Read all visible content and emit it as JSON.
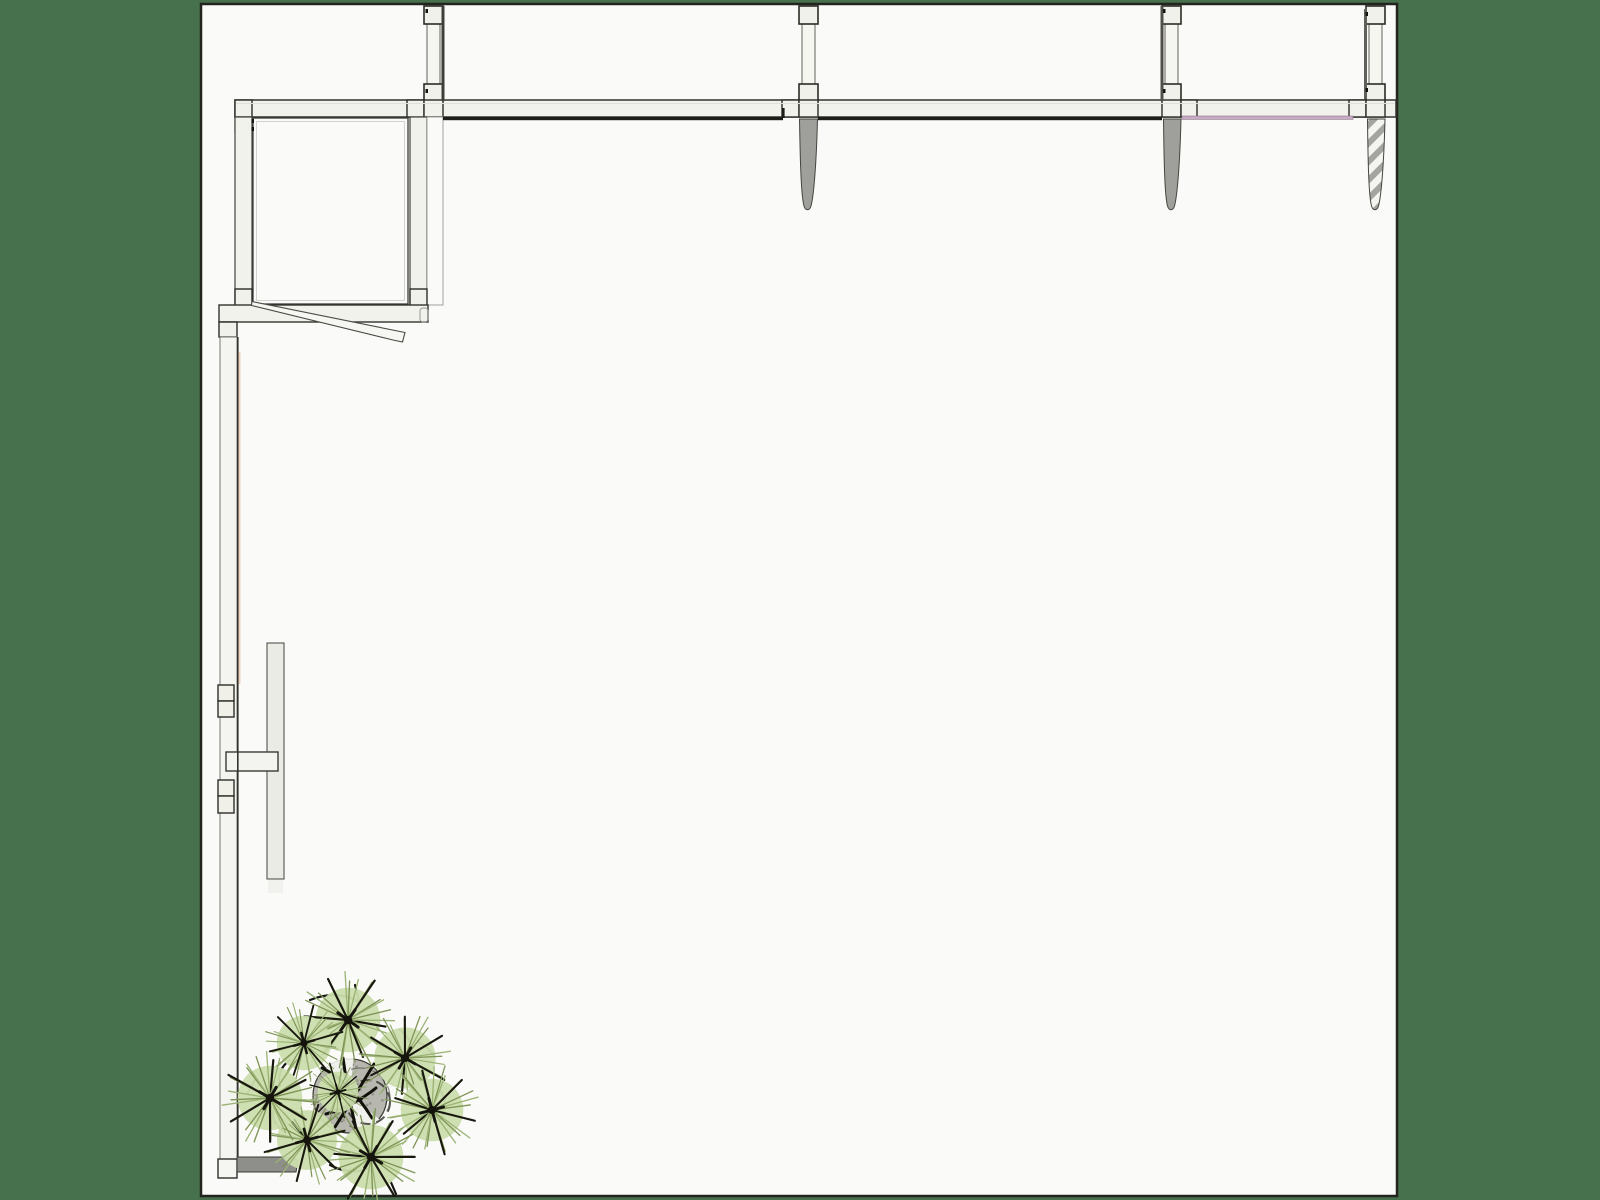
{
  "app": {
    "description": "Architectural CAD plan view drawing of a pergola corner structure with columns, cast shadows, a sliding door wall and a pine tree symbol",
    "background_color": "#47704c",
    "canvas_color": "#fafaf8",
    "line_color": "#2c2c27",
    "shadow_color": "#1d1d1a",
    "accent_pink": "#c7abc5",
    "accent_peach": "#e9c6ab",
    "plant_green": "#cbddad"
  },
  "drawing": {
    "canvas": {
      "name": "paper-canvas",
      "x": 201,
      "y": 4,
      "w": 1196,
      "h": 1192,
      "fill": "#fafaf8",
      "stroke": "#24241f",
      "sw": 2.5
    },
    "rects": [
      [
        "beam-top",
        235,
        100,
        1161,
        17,
        "#f2f2ed",
        "#33332e",
        1.5,
        0
      ],
      [
        "column-1-shaft",
        427,
        6,
        13,
        96,
        "#f6f6f1",
        "#63635d",
        1,
        0
      ],
      [
        "column-1-top-block",
        424,
        6,
        19,
        18,
        "#f1f1eb",
        "#2c2c27",
        1.6,
        0
      ],
      [
        "column-1-mid-block",
        424,
        84,
        19,
        17,
        "#f1f1eb",
        "#2c2c27",
        1.6,
        0
      ],
      [
        "column-1-beam-block-left",
        407,
        100,
        17,
        17,
        "#f2f2ec",
        "#2c2c27",
        1.4,
        0
      ],
      [
        "column-1-beam-block",
        424,
        100,
        19,
        17,
        "#f2f2ec",
        "#2c2c27",
        1.4,
        0
      ],
      [
        "column-1-under-block",
        424,
        117,
        18,
        15,
        "#f2f2ec",
        "#44443e",
        1.1,
        0
      ],
      [
        "column-2-shaft",
        802,
        6,
        13,
        96,
        "#f6f6f1",
        "#63635d",
        1,
        0
      ],
      [
        "column-2-top-block",
        799,
        6,
        19,
        18,
        "#f1f1eb",
        "#2c2c27",
        1.6,
        0
      ],
      [
        "column-2-mid-block",
        799,
        84,
        19,
        17,
        "#f1f1eb",
        "#2c2c27",
        1.6,
        0
      ],
      [
        "column-2-beam-block-left",
        782,
        100,
        17,
        17,
        "#f2f2ec",
        "#2c2c27",
        1.4,
        0
      ],
      [
        "column-2-beam-block",
        799,
        100,
        19,
        17,
        "#f2f2ec",
        "#2c2c27",
        1.4,
        0
      ],
      [
        "column-3-shaft",
        1165,
        6,
        13,
        96,
        "#f6f6f1",
        "#63635d",
        1,
        0
      ],
      [
        "column-3-top-block",
        1162,
        6,
        19,
        18,
        "#f1f1eb",
        "#2c2c27",
        1.6,
        0
      ],
      [
        "column-3-mid-block",
        1162,
        84,
        19,
        17,
        "#f1f1eb",
        "#2c2c27",
        1.6,
        0
      ],
      [
        "column-3-beam-block",
        1162,
        100,
        19,
        17,
        "#f2f2ec",
        "#2c2c27",
        1.4,
        0
      ],
      [
        "column-3-beam-block-right",
        1181,
        100,
        16,
        17,
        "#f2f2ec",
        "#2c2c27",
        1.4,
        0
      ],
      [
        "column-4-shaft",
        1369,
        6,
        13,
        96,
        "#f6f6f1",
        "#63635d",
        1,
        0
      ],
      [
        "column-4-top-block",
        1366,
        6,
        19,
        18,
        "#f1f1eb",
        "#2c2c27",
        1.6,
        0
      ],
      [
        "column-4-mid-block",
        1366,
        84,
        19,
        17,
        "#f1f1eb",
        "#2c2c27",
        1.6,
        0
      ],
      [
        "column-4-beam-block-left",
        1349,
        100,
        17,
        17,
        "#f2f2ec",
        "#2c2c27",
        1.4,
        0
      ],
      [
        "column-4-beam-block",
        1366,
        100,
        19,
        17,
        "#f2f2ec",
        "#2c2c27",
        1.4,
        0
      ],
      [
        "column-1-edge-shadow",
        441.5,
        6,
        3,
        95,
        "#3f3f3a",
        "none",
        0,
        0
      ],
      [
        "column-3-edge-shadow",
        1160.5,
        6,
        3,
        95,
        "#504f4a",
        "none",
        0,
        0
      ],
      [
        "column-4-edge-shadow",
        1364,
        9,
        3,
        90,
        "#605f59",
        "none",
        0,
        0
      ],
      [
        "beam-end-block",
        235,
        100,
        17,
        17,
        "#f1f1eb",
        "#2c2c27",
        1.4,
        0
      ],
      [
        "beam-end-block-lower",
        235,
        117,
        17,
        16,
        "#f1f1eb",
        "#2c2c27",
        1.2,
        0
      ],
      [
        "room-left-wall",
        235,
        117,
        17,
        189,
        "#f2f2ed",
        "#44443e",
        1.2,
        0
      ],
      [
        "room-right-wall",
        410,
        117,
        17,
        189,
        "#f2f2ed",
        "#44443e",
        1.2,
        0
      ],
      [
        "room-right-wall-outer",
        427,
        117,
        16,
        188,
        "#fafaf8",
        "#8b8b85",
        0.8,
        0
      ],
      [
        "room-inner-outline",
        253,
        118,
        155,
        186,
        "none",
        "#3b3b36",
        1.3,
        0
      ],
      [
        "room-inner-offset",
        256.5,
        121.5,
        148,
        179,
        "none",
        "#c9c9c3",
        0.8,
        0
      ],
      [
        "room-corner-block-left",
        235,
        289,
        17,
        17,
        "#f1f1eb",
        "#2c2c27",
        1.4,
        0
      ],
      [
        "room-corner-block-right",
        410,
        289,
        17,
        17,
        "#f1f1eb",
        "#2c2c27",
        1.4,
        0
      ],
      [
        "room-bottom-beam",
        219,
        305,
        209,
        17,
        "#f2f2ed",
        "#33332e",
        1.4,
        0
      ],
      [
        "room-bottom-beam-tab",
        420,
        308,
        8,
        14,
        "none",
        "#9a9a94",
        1,
        3
      ],
      [
        "wall-top-block",
        219,
        322,
        18,
        15,
        "#f1f1eb",
        "#2c2c27",
        1.4,
        0
      ],
      [
        "left-wall",
        220,
        337,
        17,
        822,
        "#f4f4f0",
        "#77776f",
        1,
        0
      ],
      [
        "wall-plate-1",
        218,
        685,
        16,
        16,
        "#f0f0e9",
        "#2e2e29",
        1.4,
        0
      ],
      [
        "wall-plate-2",
        218,
        701,
        16,
        16,
        "#f0f0e9",
        "#2e2e29",
        1.4,
        0
      ],
      [
        "wall-plate-3",
        218,
        780,
        16,
        16,
        "#f0f0e9",
        "#2e2e29",
        1.4,
        0
      ],
      [
        "wall-plate-4",
        218,
        796,
        16,
        17,
        "#f0f0e9",
        "#2e2e29",
        1.4,
        0
      ],
      [
        "sliding-door-leaf",
        267,
        643,
        17,
        236,
        "#ebebe6",
        "#55524c",
        1.1,
        0
      ],
      [
        "sliding-door-leaf-shadow",
        268,
        880,
        15,
        13,
        "#f1f1ee",
        "none",
        0,
        0
      ],
      [
        "door-handle-bar",
        226,
        752,
        52,
        19,
        "#f3f3ef",
        "#3a3a34",
        1.4,
        0
      ],
      [
        "wall-end-block",
        218,
        1159,
        19,
        19,
        "#f5f5f1",
        "#2e2e29",
        1.4,
        0
      ],
      [
        "beam-shadow-segment-1",
        443,
        117,
        340,
        3.2,
        "#1d1d1a",
        "none",
        0,
        0
      ],
      [
        "beam-shadow-segment-2",
        818,
        117,
        344,
        3.2,
        "#1d1d1a",
        "none",
        0,
        0
      ],
      [
        "beam-shadow-tick",
        782,
        108,
        2.6,
        10,
        "#1d1d1a",
        "none",
        0,
        0
      ],
      [
        "pink-trim-line",
        1182,
        116,
        171,
        3.4,
        "#c7abc5",
        "#8a7587",
        0.6,
        0
      ]
    ],
    "lines": [
      [
        "beam-inner-highlight",
        236,
        103.5,
        1395,
        103.5,
        "#e0e0da",
        1,
        1
      ],
      [
        "wall-right-edge",
        237.8,
        337,
        237.8,
        1159,
        "#33332e",
        1.6,
        1
      ],
      [
        "peach-trim-line",
        239.5,
        352,
        239.5,
        684,
        "#e9c6ab",
        2,
        0.75
      ]
    ],
    "paths": [
      [
        "door-leaf-diagonal",
        "M252,301.5 L405,332.5 L402.5,342 L393,340 L251.5,305.5 Z",
        "#f6f6f2",
        "#4a4a44",
        1.1,
        1,
        ""
      ],
      [
        "column-2-cast-shadow",
        "M799.5,119 L817.5,119 C816.5,160 814,195 811,206 C809.5,211 805.5,211 804,206 C801,195 800.2,160 799.5,119 Z",
        "#9f9f9b",
        "#45453f",
        1,
        1,
        ""
      ],
      [
        "column-3-cast-shadow",
        "M1163.5,119 L1181,119 C1180,160 1177.5,195 1174.5,206 C1173,211 1169,211 1167.5,206 C1164.6,195 1164,160 1163.5,119 Z",
        "#9f9f9b",
        "#45453f",
        1,
        1,
        ""
      ],
      [
        "column-4-cast-shadow-hatched",
        "M1367.5,119 L1385,119 C1384,160 1381.5,195 1378.5,206 C1377,211 1373,211 1371.5,206 C1368.6,195 1368,160 1367.5,119 Z",
        "url(#hatch45)",
        "#45453f",
        1,
        1,
        ""
      ],
      [
        "ground-shadow-bar",
        "M237,1157 L293,1157 L298,1161 L296,1172 L237,1172 Z",
        "#8e8e8a",
        "#3c3c37",
        1,
        1,
        ""
      ]
    ],
    "marks": [
      [
        251.5,
        119
      ],
      [
        251.5,
        127
      ],
      [
        425.5,
        9
      ],
      [
        425.5,
        89
      ],
      [
        1163,
        9
      ],
      [
        1163,
        89
      ],
      [
        1365.5,
        12
      ],
      [
        1365.5,
        88
      ]
    ],
    "hatch": {
      "size": 13,
      "stripe": 6,
      "bg": "#f4f4f1",
      "fg": "#a4a4a0",
      "angle": 45
    },
    "plant": {
      "trunk": {
        "cx": 350,
        "cy": 1096,
        "r": 37,
        "fill": "#b7b7b0",
        "stroke": "#3b3b35",
        "sw": 1.2,
        "speckles": 40,
        "speckle_fill": "#8e8e87",
        "rings": [
          [
            368,
            1102,
            22,
            "#2e2e28",
            2,
            "10 6",
            0.8
          ],
          [
            360,
            1098,
            30,
            "#55554e",
            1.2,
            "14 8",
            0.7
          ]
        ],
        "wedges": [
          "M350,1096 L318,1058 A50,50 0 0 1 354,1052 Z",
          "M350,1096 L388,1126 A48,48 0 0 1 360,1142 Z"
        ],
        "branches": [
          "M322,1068 Q349,1081 372,1118",
          "M374,1064 Q356,1094 335,1127",
          "M326,1114 Q352,1107 376,1088",
          "M343,1058 Q348,1096 357,1133"
        ]
      },
      "pompom": {
        "disc_r": 34,
        "disc_fill": "#cbddad",
        "rays": 30,
        "len_base": 40,
        "len_var": 13,
        "ray_colors": [
          "#18180f",
          "#7e9355",
          "#9ab374"
        ],
        "core_fill": "#15150e"
      },
      "instances": [
        [
          348,
          1020,
          0.95,
          10
        ],
        [
          304,
          1043,
          0.8,
          50
        ],
        [
          405,
          1058,
          0.9,
          95
        ],
        [
          432,
          1110,
          0.92,
          140
        ],
        [
          371,
          1157,
          0.95,
          185
        ],
        [
          307,
          1140,
          0.88,
          230
        ],
        [
          270,
          1098,
          0.95,
          275
        ],
        [
          338,
          1092,
          0.6,
          320
        ]
      ],
      "twigs": [
        "M310,1000 q25,-10 45,0 q8,4 0,10",
        "M400,1030 q14,10 10,26",
        "M440,1090 q10,16 0,30",
        "M290,1060 q-14,10 -10,26",
        "M330,1165 q18,10 38,4",
        "M282,1130 q-12,-10 -8,-22",
        "M355,985 l4,16",
        "M418,1042 q10,4 16,14",
        "M255,1080 l-8,14",
        "M390,1180 l6,14"
      ]
    }
  }
}
